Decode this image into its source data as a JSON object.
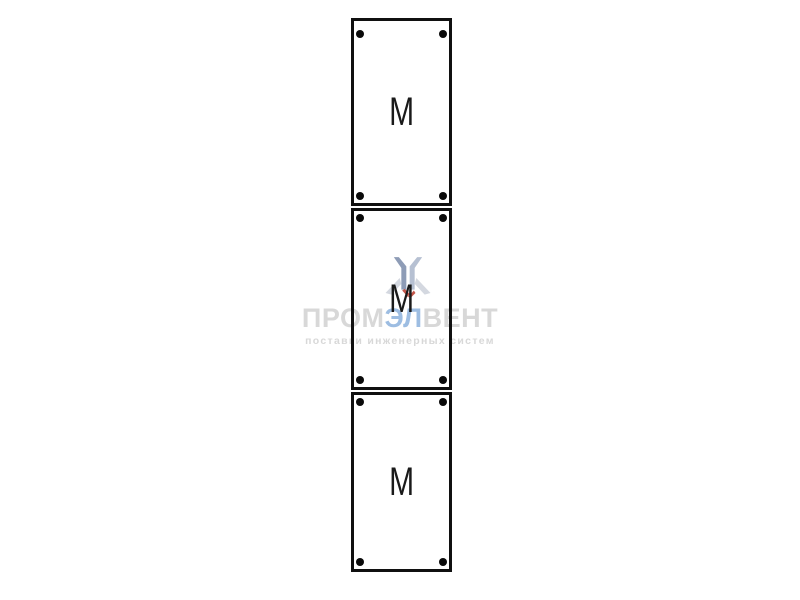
{
  "page": {
    "background": "#ffffff"
  },
  "watermark": {
    "brand": {
      "prefix": "ПРОМ",
      "accent": "ЭЛ",
      "suffix": "ВЕНТ"
    },
    "tagline": "поставки инженерных систем",
    "colors": {
      "text_gray": "#d8d8d8",
      "accent_blue": "#9dbde2",
      "logo_slate": "#8e9cb6",
      "logo_slate_light": "#b6c0d2",
      "logo_wing": "#d4d8e0",
      "logo_red": "#c4564a"
    }
  },
  "panel": {
    "border_color": "#101010",
    "screw_color": "#0a0a0a",
    "modules": [
      {
        "label": "M"
      },
      {
        "label": "M"
      },
      {
        "label": "M"
      }
    ]
  }
}
